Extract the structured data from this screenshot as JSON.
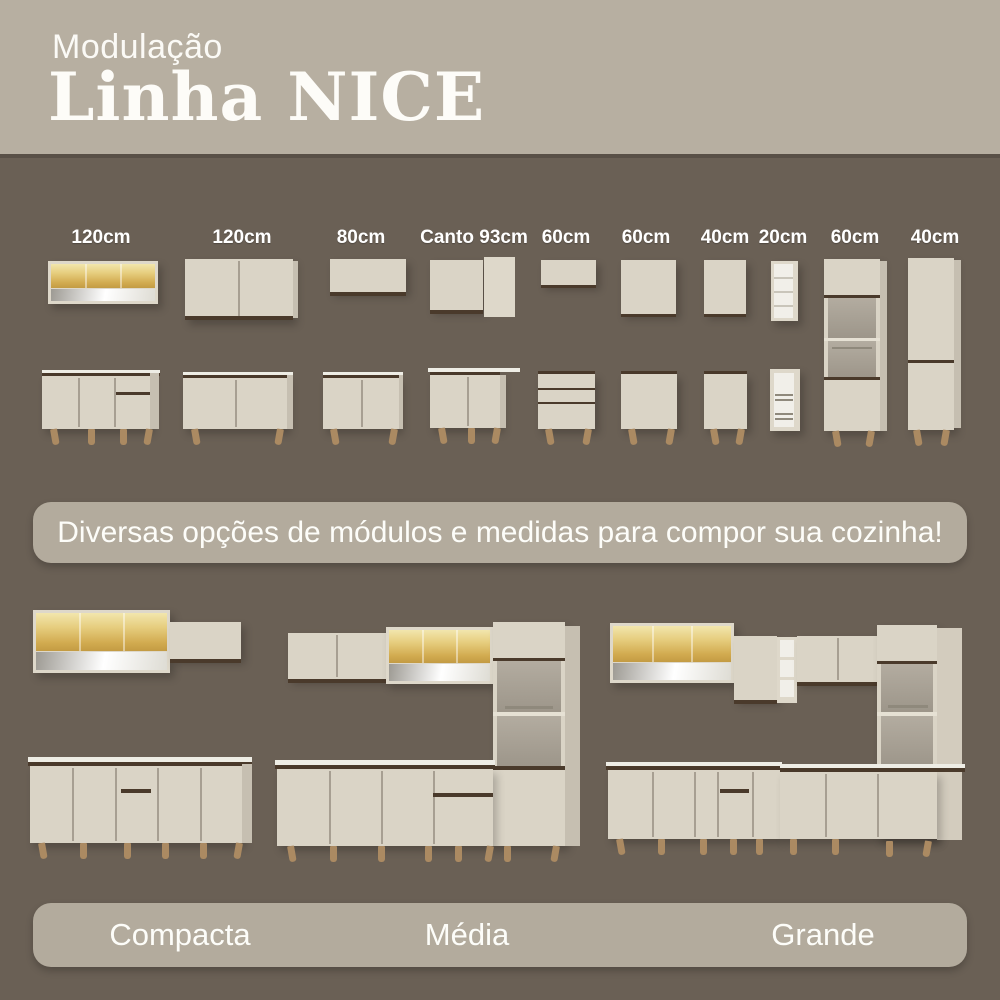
{
  "header": {
    "subtitle": "Modulação",
    "title": "Linha NICE"
  },
  "modules": [
    {
      "size": "120cm",
      "kind": "wall-display-cabinet-amber-glass-open-shelf / base-3-doors-1-drawer"
    },
    {
      "size": "120cm",
      "kind": "wall-2-door-cabinet / base-2-door-cabinet"
    },
    {
      "size": "80cm",
      "kind": "wall-1-door-cabinet / base-2-door-cabinet"
    },
    {
      "size": "Canto 93cm",
      "kind": "corner-wall-cabinet / corner-base-cabinet"
    },
    {
      "size": "60cm",
      "kind": "wall-1-door-cabinet / base-drawer-unit"
    },
    {
      "size": "60cm",
      "kind": "wall-1-door-cabinet / base-1-door-cabinet"
    },
    {
      "size": "40cm",
      "kind": "wall-1-door-cabinet / base-1-door-cabinet"
    },
    {
      "size": "20cm",
      "kind": "open-shelf-niche / bottle-rack-niche"
    },
    {
      "size": "60cm",
      "kind": "tall-cabinet-with-microwave-niche"
    },
    {
      "size": "40cm",
      "kind": "tall-2-door-pantry-cabinet"
    }
  ],
  "banner": {
    "text": "Diversas opções de módulos e medidas para compor sua cozinha!"
  },
  "kitchens": [
    {
      "label": "Compacta"
    },
    {
      "label": "Média"
    },
    {
      "label": "Grande"
    }
  ],
  "colors": {
    "background": "#6a6055",
    "header_bg": "#b7afa1",
    "banner_bg": "#b3ab9d",
    "cabinet_cream": "#dad4c6",
    "wood_trim": "#4a3a2b",
    "amber_glass": "#e6cd7e",
    "legs_wood": "#ab8a62",
    "text": "#ffffff"
  }
}
